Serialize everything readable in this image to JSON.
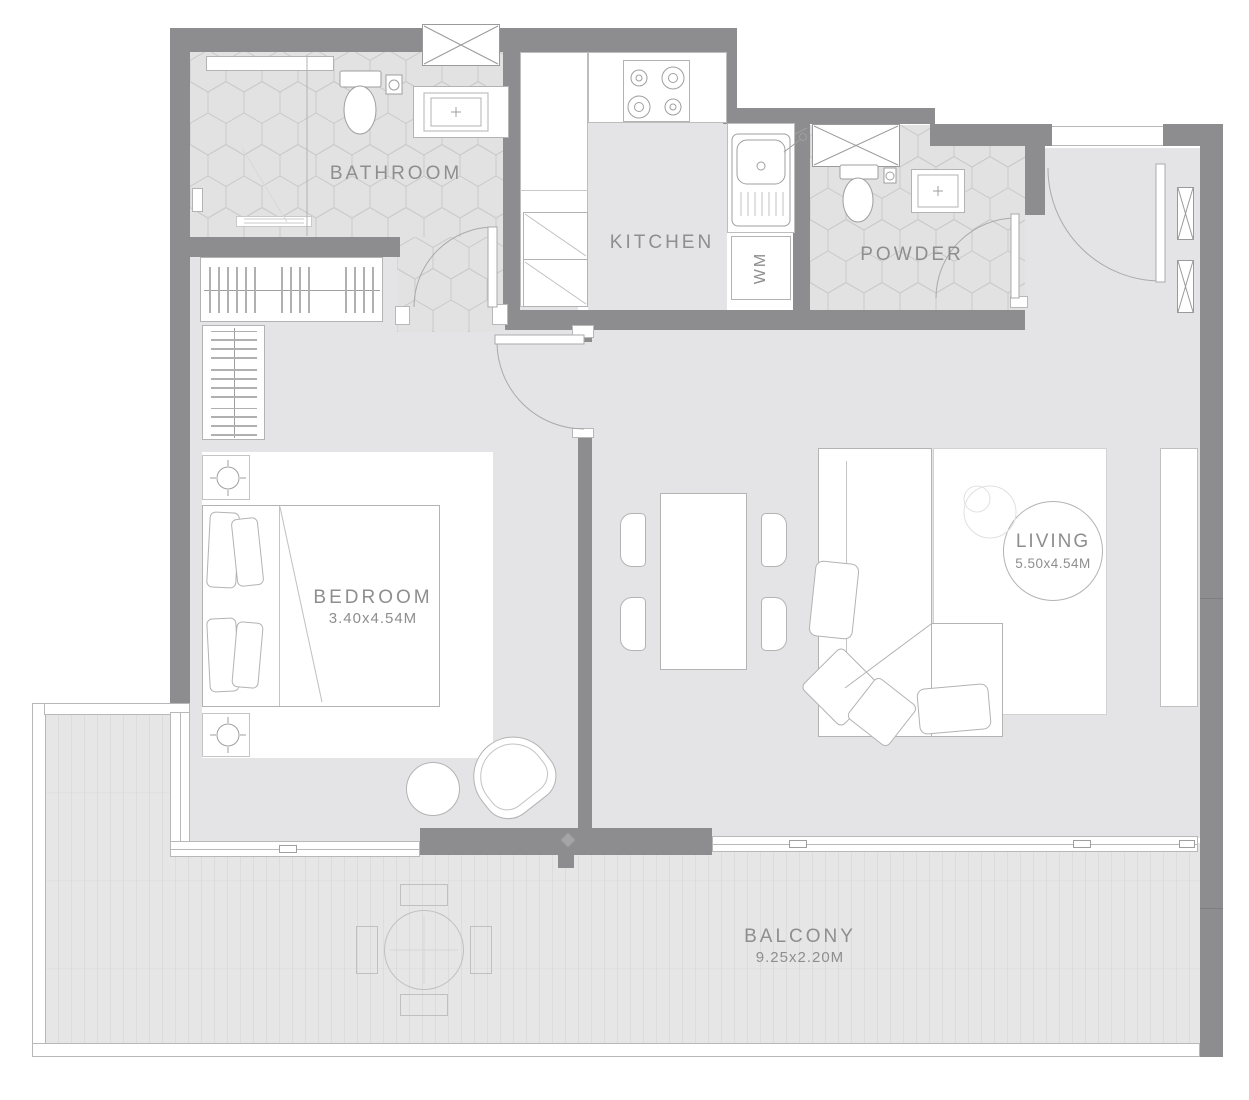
{
  "meta": {
    "drawing_type": "apartment floor plan"
  },
  "colors": {
    "wall": "#8d8d8f",
    "floor": "#e4e4e6",
    "furniture_line": "#b3b3b3",
    "tile_line": "#c9c9c9",
    "text": "#8e8e8e"
  },
  "rooms": {
    "bathroom": {
      "label": "BATHROOM"
    },
    "kitchen": {
      "label": "KITCHEN"
    },
    "powder": {
      "label": "POWDER"
    },
    "bedroom": {
      "label": "BEDROOM",
      "dims": "3.40x4.54M"
    },
    "living": {
      "label": "LIVING",
      "dims": "5.50x4.54M"
    },
    "balcony": {
      "label": "BALCONY",
      "dims": "9.25x2.20M"
    },
    "utility": {
      "washing_machine_label": "WM"
    }
  }
}
